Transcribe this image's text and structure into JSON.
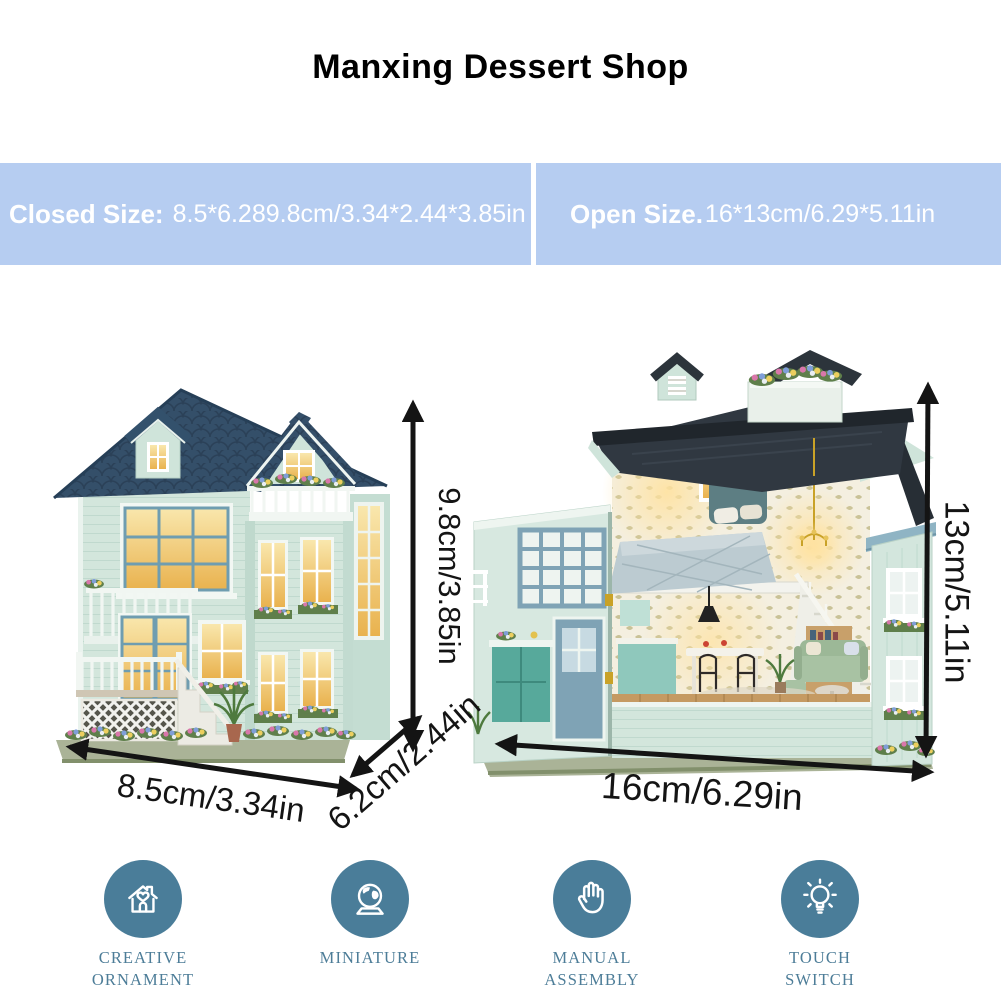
{
  "title": "Manxing Dessert Shop",
  "banners": {
    "closed": {
      "label": "Closed Size:",
      "value": "8.5*6.289.8cm/3.34*2.44*3.85in"
    },
    "open": {
      "label": "Open Size.",
      "value": "16*13cm/6.29*5.11in"
    }
  },
  "product": {
    "closed_view": {
      "height": "9.8cm/3.85in",
      "width": "8.5cm/3.34in",
      "depth": "6.2cm/2.44in"
    },
    "open_view": {
      "width": "16cm/6.29in",
      "height": "13cm/5.11in"
    }
  },
  "features": [
    {
      "icon": "house-heart-icon",
      "lines": [
        "CREATIVE",
        "ORNAMENT"
      ]
    },
    {
      "icon": "miniature-globe-icon",
      "lines": [
        "MINIATURE",
        ""
      ]
    },
    {
      "icon": "manual-hand-icon",
      "lines": [
        "MANUAL",
        "ASSEMBLY"
      ]
    },
    {
      "icon": "light-bulb-icon",
      "lines": [
        "TOUCH",
        "SWITCH"
      ]
    }
  ],
  "colors": {
    "banner_bg": "#b6cdf1",
    "banner_text": "#ffffff",
    "icon_circle": "#4a7d99",
    "icon_label_text": "#4d7d98",
    "arrow": "#141414",
    "roof_navy": "#344f69",
    "roof_dark": "#303841",
    "wall_mint": "#d3e6dc",
    "window_glow": "#e9b24e"
  }
}
